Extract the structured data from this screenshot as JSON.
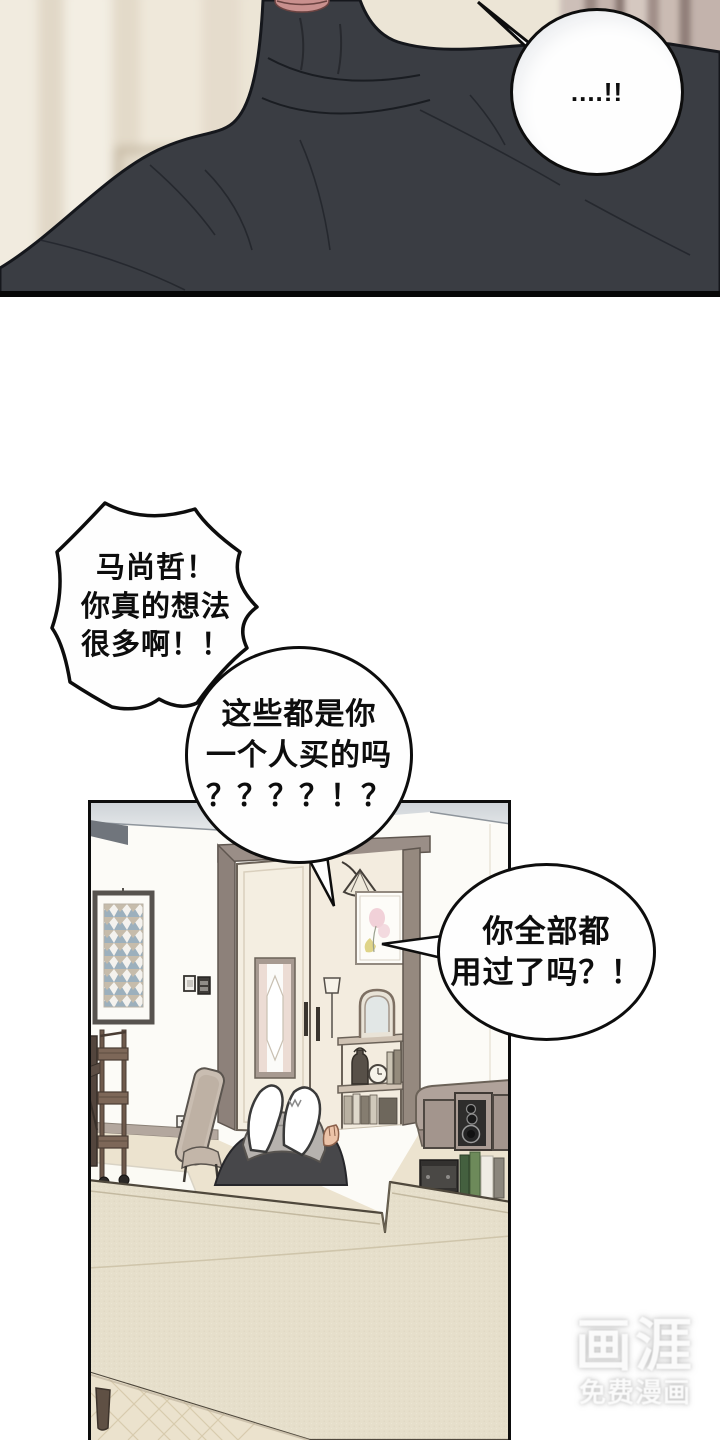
{
  "page": {
    "kind": "manhwa comic page",
    "panel_top_alt": "close-up of a broad-shouldered man in a dark turtleneck, face cropped at the lips",
    "panel_room_alt": "living room with open double door, bunny-eared figure behind a sofa, shelf, speakers and cart"
  },
  "bubble_shock": {
    "text": "....!!"
  },
  "bubble_burst": {
    "lines": [
      "马尚哲！",
      "你真的想法",
      "很多啊！！"
    ]
  },
  "bubble_question": {
    "lines": [
      "这些都是你",
      "一个人买的吗",
      "？？？？！？"
    ]
  },
  "bubble_followup": {
    "lines": [
      "你全部都",
      "用过了吗？！"
    ]
  },
  "watermark": {
    "logo": "画涯",
    "tagline": "免费漫画"
  },
  "colors": {
    "ink": "#0d0d0d",
    "sweater": "#3a3d43",
    "lips": "#c9908e",
    "wall_cream": "#eae2d3",
    "curtain": "#b5a39c",
    "ceiling": "#d9dde0",
    "door_leaf": "#f4eee1",
    "door_frame": "#988c85",
    "sofa": "#e6dfcb",
    "hood": "#b6b2ae",
    "skin": "#ecc3a8",
    "wood_cart": "#7a6557",
    "floor": "#ece3cf"
  }
}
